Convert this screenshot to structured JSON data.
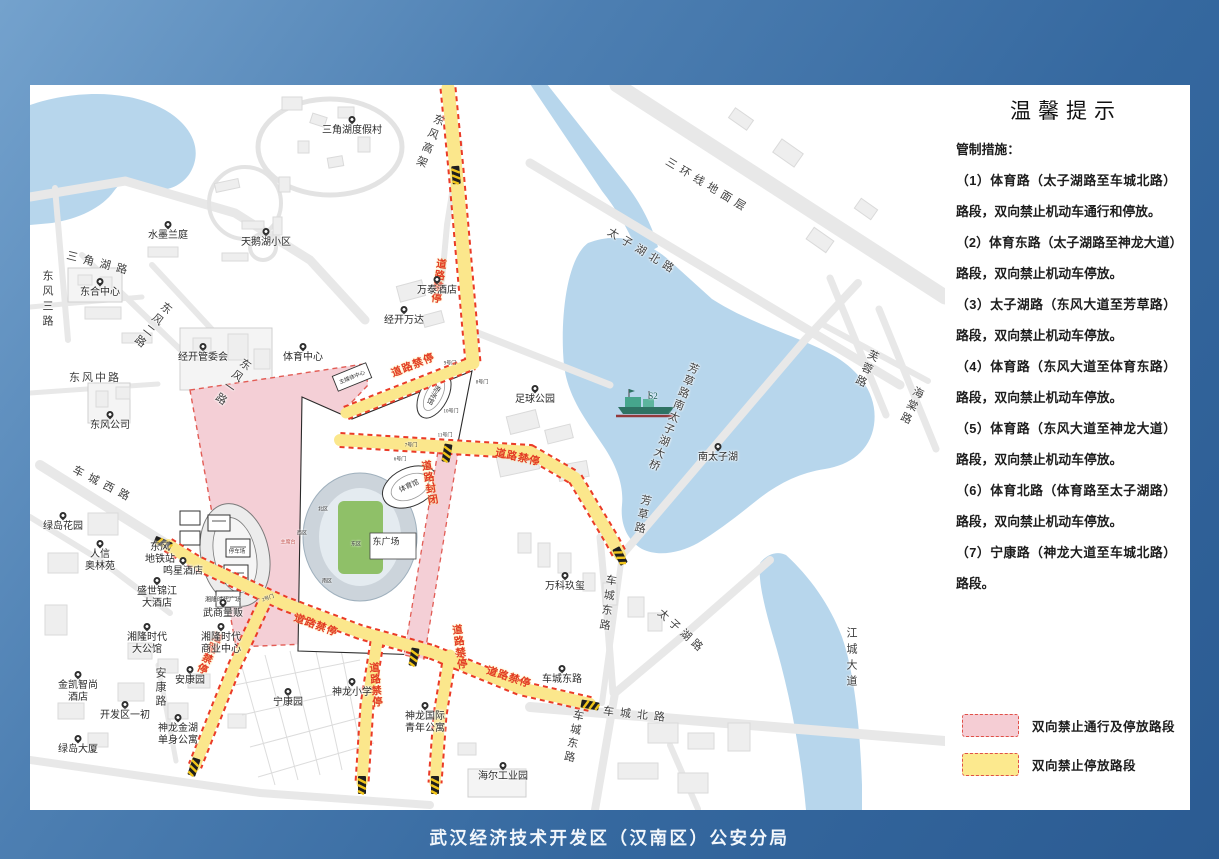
{
  "notice": {
    "title": "温馨提示",
    "intro": "管制措施：",
    "items": [
      "（1）体育路（太子湖路至车城北路）路段，双向禁止机动车通行和停放。",
      "（2）体育东路（太子湖路至神龙大道）路段，双向禁止机动车停放。",
      "（3）太子湖路（东风大道至芳草路）路段，双向禁止机动车停放。",
      "（4）体育路（东风大道至体育东路）路段，双向禁止机动车停放。",
      "（5）体育路（东风大道至神龙大道）路段，双向禁止机动车停放。",
      "（6）体育北路（体育路至太子湖路）路段，双向禁止机动车停放。",
      "（7）宁康路（神龙大道至车城北路）路段。"
    ]
  },
  "legend": {
    "items": [
      {
        "label": "双向禁止通行及停放路段",
        "fill": "#f5cdd4",
        "stroke": "#e05048"
      },
      {
        "label": "双向禁止停放路段",
        "fill": "#fce98e",
        "stroke": "#e05048"
      }
    ]
  },
  "footer": "武汉经济技术开发区（汉南区）公安分局",
  "colors": {
    "background_gradient": [
      "#74a2cd",
      "#2b5b92"
    ],
    "water": "#b7d6ec",
    "road": "#e8e8e8",
    "restricted_road_fill": "#fbe78c",
    "restriction_border_red": "#ea3b28",
    "closed_zone_fill": "#f4cfd6",
    "stadium_field": "#8fc068"
  },
  "map": {
    "poi_markers": [
      {
        "t": "三角湖度假村",
        "x": 322,
        "y": 38
      },
      {
        "t": "水墨兰庭",
        "x": 138,
        "y": 143
      },
      {
        "t": "天鹅湖小区",
        "x": 236,
        "y": 150
      },
      {
        "t": "万泰酒店",
        "x": 407,
        "y": 198
      },
      {
        "t": "经开万达",
        "x": 374,
        "y": 228
      },
      {
        "t": "东合中心",
        "x": 70,
        "y": 200
      },
      {
        "t": "经开管委会",
        "x": 173,
        "y": 265
      },
      {
        "t": "东风公司",
        "x": 80,
        "y": 333
      },
      {
        "t": "体育中心",
        "x": 273,
        "y": 265
      },
      {
        "t": "足球公园",
        "x": 505,
        "y": 307
      },
      {
        "t": "南太子湖",
        "x": 688,
        "y": 365
      },
      {
        "t": "万科玖玺",
        "x": 535,
        "y": 494
      },
      {
        "t": "车城东路",
        "x": 532,
        "y": 587
      },
      {
        "t": "人信",
        "t2": "奥林苑",
        "x": 70,
        "y": 462
      },
      {
        "t": "绿岛花园",
        "x": 33,
        "y": 434
      },
      {
        "t": "鸣星酒店",
        "x": 153,
        "y": 479
      },
      {
        "t": "盛世锦江",
        "t2": "大酒店",
        "x": 127,
        "y": 499
      },
      {
        "t": "武商量贩",
        "x": 193,
        "y": 521
      },
      {
        "t": "湘隆时代",
        "t2": "大公馆",
        "x": 117,
        "y": 545
      },
      {
        "t": "湘隆时代",
        "t2": "商业中心",
        "x": 191,
        "y": 545
      },
      {
        "t": "金凯智尚",
        "t2": "酒店",
        "x": 48,
        "y": 593
      },
      {
        "t": "安康园",
        "x": 160,
        "y": 588
      },
      {
        "t": "开发区一初",
        "x": 95,
        "y": 623
      },
      {
        "t": "神龙金湖",
        "t2": "单身公寓",
        "x": 148,
        "y": 636
      },
      {
        "t": "绿岛大厦",
        "x": 48,
        "y": 657
      },
      {
        "t": "宁康园",
        "x": 258,
        "y": 610
      },
      {
        "t": "神龙小学",
        "x": 322,
        "y": 600
      },
      {
        "t": "神龙国际",
        "t2": "青年公寓",
        "x": 395,
        "y": 624
      },
      {
        "t": "海尔工业园",
        "x": 473,
        "y": 684
      },
      {
        "t": "东风",
        "t2": "地铁站",
        "x": 130,
        "y": 455,
        "nopin": true
      }
    ],
    "road_labels": [
      {
        "t": "三角湖路",
        "x": 70,
        "y": 178,
        "r": 14,
        "ls": 6
      },
      {
        "t": "东风三路",
        "x": 17,
        "y": 215,
        "v": 1,
        "ls": 4
      },
      {
        "t": "东风二路",
        "x": 122,
        "y": 240,
        "v": 1,
        "r": 38
      },
      {
        "t": "东风一路",
        "x": 202,
        "y": 297,
        "v": 1,
        "r": 35
      },
      {
        "t": "东风中路",
        "x": 65,
        "y": 292,
        "ls": 2
      },
      {
        "t": "车城西路",
        "x": 74,
        "y": 399,
        "r": 27,
        "ls": 6
      },
      {
        "t": "东风高架",
        "x": 399,
        "y": 57,
        "v": 1,
        "r": 22,
        "ls": 4
      },
      {
        "t": "三环线地面层",
        "x": 678,
        "y": 100,
        "r": 31,
        "ls": 5
      },
      {
        "t": "太子湖北路",
        "x": 613,
        "y": 166,
        "r": 31,
        "ls": 5
      },
      {
        "t": "芙蓉路",
        "x": 836,
        "y": 284,
        "v": 1,
        "r": 25
      },
      {
        "t": "海棠路",
        "x": 881,
        "y": 321,
        "v": 1,
        "r": 25
      },
      {
        "t": "芳草路南太子湖大桥",
        "x": 643,
        "y": 332,
        "v": 1,
        "r": 22,
        "ls": 2
      },
      {
        "t": "芳草路",
        "x": 612,
        "y": 430,
        "v": 1,
        "r": 12
      },
      {
        "t": "车城东路",
        "x": 577,
        "y": 519,
        "v": 1,
        "r": 8,
        "ls": 4
      },
      {
        "t": "太子湖路",
        "x": 652,
        "y": 546,
        "r": 42,
        "ls": 4
      },
      {
        "t": "车城北路",
        "x": 607,
        "y": 629,
        "r": 6,
        "ls": 6
      },
      {
        "t": "车城东路",
        "x": 543,
        "y": 652,
        "v": 1,
        "r": 12,
        "ls": 3
      },
      {
        "t": "江城大道",
        "x": 821,
        "y": 574,
        "v": 1,
        "ls": 5
      },
      {
        "t": "安康路",
        "x": 130,
        "y": 603,
        "v": 1
      }
    ],
    "warning_labels": [
      {
        "t": "道路禁停",
        "x": 408,
        "y": 196,
        "v": 1,
        "r": 8
      },
      {
        "t": "道路禁停",
        "x": 383,
        "y": 280,
        "r": -22
      },
      {
        "t": "道路禁停",
        "x": 488,
        "y": 372,
        "r": 12
      },
      {
        "t": "道路封闭",
        "x": 399,
        "y": 398,
        "v": 1,
        "r": -10
      },
      {
        "t": "道路禁停",
        "x": 286,
        "y": 540,
        "r": 20
      },
      {
        "t": "道路禁停",
        "x": 179,
        "y": 568,
        "v": 1,
        "r": 25
      },
      {
        "t": "道路禁停",
        "x": 345,
        "y": 600,
        "v": 1,
        "r": -5
      },
      {
        "t": "道路禁停",
        "x": 429,
        "y": 562,
        "v": 1,
        "r": -8
      },
      {
        "t": "道路禁停",
        "x": 479,
        "y": 592,
        "r": 18
      }
    ],
    "small_labels": [
      {
        "t": "东广场",
        "x": 356,
        "y": 456,
        "fs": 9
      },
      {
        "t": "停车场",
        "x": 207,
        "y": 466,
        "fs": 5.5
      },
      {
        "t": "主媒体中心",
        "x": 322,
        "y": 292,
        "fs": 5.5,
        "r": -22
      },
      {
        "t": "体育馆",
        "x": 379,
        "y": 401,
        "fs": 7,
        "r": -25
      },
      {
        "t": "游泳馆",
        "x": 404,
        "y": 310,
        "fs": 7,
        "v": 1,
        "r": 28
      },
      {
        "t": "北区",
        "x": 293,
        "y": 424,
        "fs": 5
      },
      {
        "t": "西区",
        "x": 272,
        "y": 448,
        "fs": 5
      },
      {
        "t": "东区",
        "x": 326,
        "y": 459,
        "fs": 5
      },
      {
        "t": "南区",
        "x": 297,
        "y": 496,
        "fs": 5
      },
      {
        "t": "主席台",
        "x": 258,
        "y": 457,
        "fs": 5,
        "c": "#c2554f"
      },
      {
        "t": "9号门",
        "x": 420,
        "y": 278,
        "fs": 5
      },
      {
        "t": "8号门",
        "x": 452,
        "y": 297,
        "fs": 5
      },
      {
        "t": "10号门",
        "x": 421,
        "y": 326,
        "fs": 5
      },
      {
        "t": "11号门",
        "x": 415,
        "y": 350,
        "fs": 5
      },
      {
        "t": "7号门",
        "x": 381,
        "y": 360,
        "fs": 5
      },
      {
        "t": "6号门",
        "x": 370,
        "y": 374,
        "fs": 5
      },
      {
        "t": "2号门",
        "x": 238,
        "y": 513,
        "fs": 5,
        "r": -20
      },
      {
        "t": "湘隆时代广场",
        "x": 193,
        "y": 514,
        "fs": 6
      },
      {
        "t": "S2",
        "x": 623,
        "y": 311,
        "fs": 9,
        "c": "#1d5f55"
      }
    ]
  }
}
